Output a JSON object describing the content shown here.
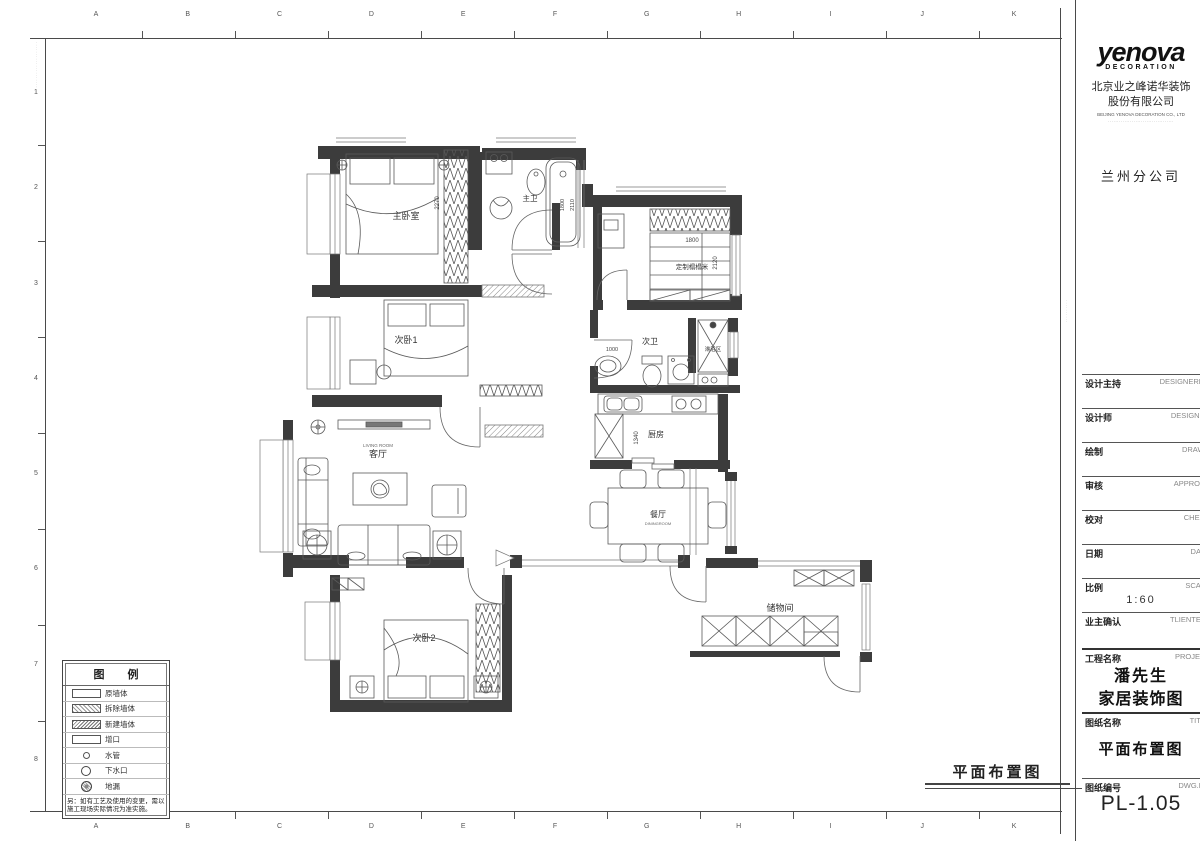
{
  "sheet": {
    "grid_top": [
      "A",
      "B",
      "C",
      "D",
      "E",
      "F",
      "G",
      "H",
      "I",
      "J",
      "K"
    ],
    "grid_bottom": [
      "A",
      "B",
      "C",
      "D",
      "E",
      "F",
      "G",
      "H",
      "I",
      "J",
      "K"
    ],
    "grid_left": [
      "1",
      "2",
      "3",
      "4",
      "5",
      "6",
      "7",
      "8"
    ],
    "caption": "平面布置图"
  },
  "plan": {
    "rooms": {
      "master_bedroom": "主卧室",
      "master_bath": "主卫",
      "tatami": "定制榻榻米",
      "bedroom1": "次卧1",
      "bath2": "次卫",
      "shower": "淋浴区",
      "kitchen": "厨房",
      "living": "客厅",
      "living_en": "LIVING ROOM",
      "dining": "餐厅",
      "dining_en": "DININGROOM",
      "bedroom2": "次卧2",
      "storage": "储物间"
    },
    "dims": {
      "master_closet": "2270",
      "tub_w": "1800",
      "tub_l": "2110",
      "tatami_w": "1800",
      "tatami_l": "2120",
      "bath2_door": "1000",
      "kitchen_w": "1340"
    }
  },
  "legend": {
    "title": "图 例",
    "items": [
      {
        "symbol": "wall-original",
        "label": "原墙体"
      },
      {
        "symbol": "wall-demolish",
        "label": "拆除墙体"
      },
      {
        "symbol": "wall-new",
        "label": "新建墙体"
      },
      {
        "symbol": "opening",
        "label": "增口"
      },
      {
        "symbol": "water-pipe",
        "label": "水管"
      },
      {
        "symbol": "drain-outlet",
        "label": "下水口"
      },
      {
        "symbol": "floor-drain",
        "label": "地漏"
      }
    ],
    "note": "另：如有工艺及使用的变更，需以施工现场实际情况为准实施。"
  },
  "title_block": {
    "logo": "yenova",
    "logo_sub": "DECORATION",
    "company_cn1": "北京业之峰诺华装饰",
    "company_cn2": "股份有限公司",
    "company_en": "BEIJING YENOVA DECORATION CO., LTD",
    "branch": "兰州分公司",
    "issue_table": {
      "no": "NO.",
      "issue": "Issue",
      "date": "Date",
      "rows": [
        "△",
        "X:"
      ]
    },
    "notice": "非本公司设计师之书面批准不得随意将任何部分翻印，切勿以比例量度此图，一切以图内数字所示为准。承建人必须在工地核对图内所示数字之准确，如发现有矛盾处，应立即通知设计师。图纸版权归本公司所有。",
    "fields": [
      {
        "cn": "设计主持",
        "en": "DESIGNERHO"
      },
      {
        "cn": "设计师",
        "en": "DESIGNER"
      },
      {
        "cn": "绘制",
        "en": "DRAWN"
      },
      {
        "cn": "审核",
        "en": "APPROVE"
      },
      {
        "cn": "校对",
        "en": "CHECK"
      },
      {
        "cn": "日期",
        "en": "DATE"
      }
    ],
    "scale": {
      "cn": "比例",
      "en": "SCALE",
      "value": "1:60"
    },
    "client": {
      "cn": "业主确认",
      "en": "TLIENTELE"
    },
    "project": {
      "cn": "工程名称",
      "en": "PROJECT",
      "value1": "潘先生",
      "value2": "家居装饰图"
    },
    "drawing": {
      "cn": "图纸名称",
      "en": "TITLE",
      "value": "平面布置图"
    },
    "number": {
      "cn": "图纸编号",
      "en": "DWG.NO",
      "value": "PL-1.05"
    }
  }
}
